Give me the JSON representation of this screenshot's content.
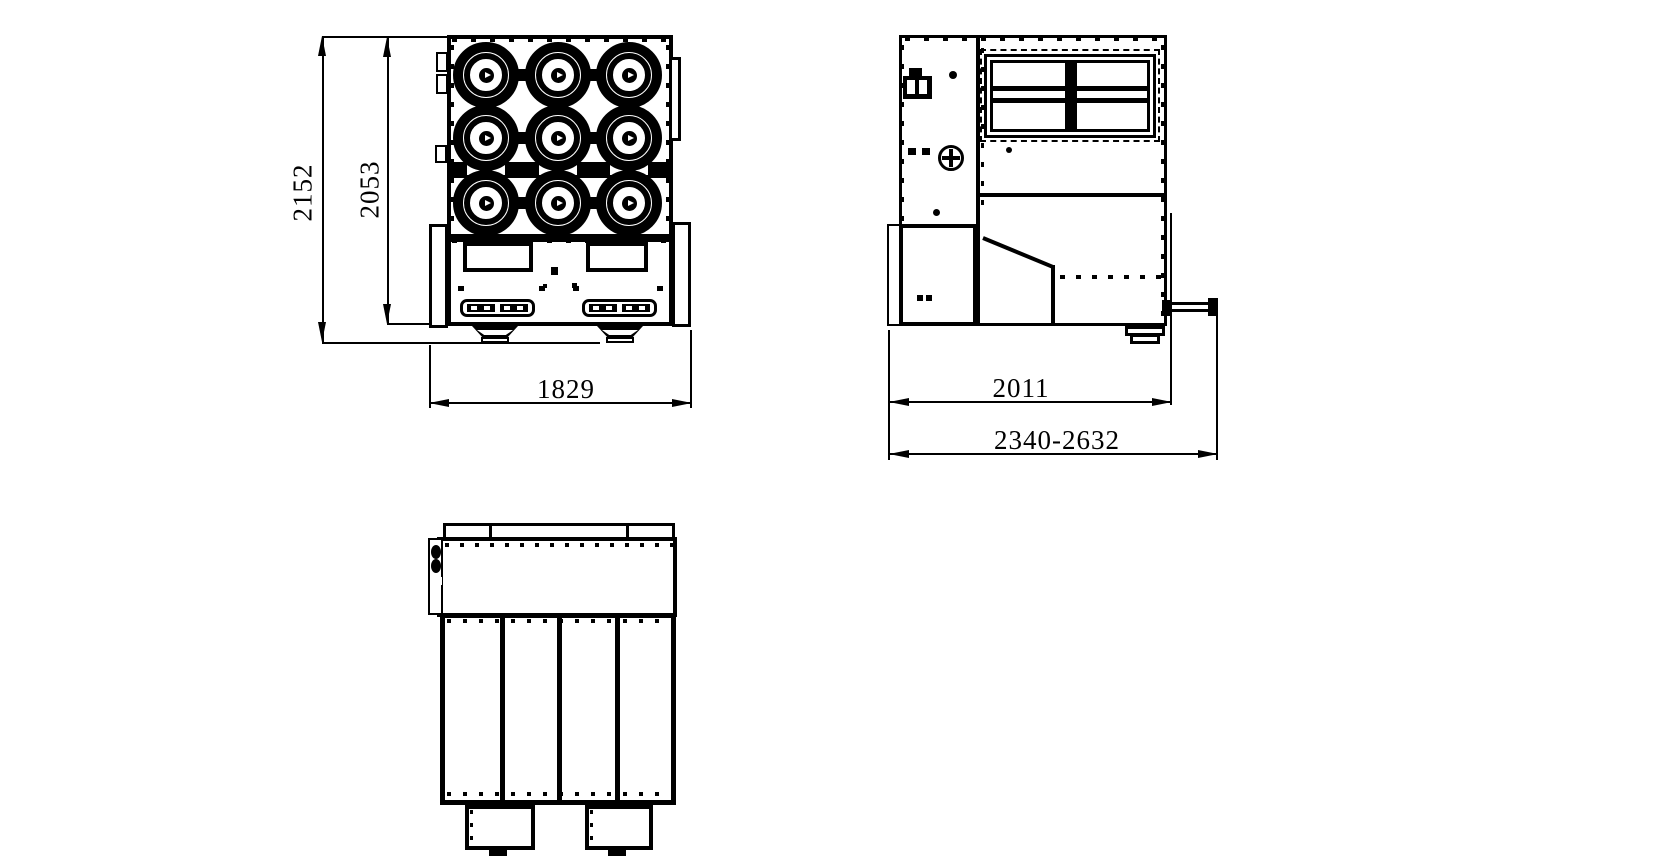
{
  "colors": {
    "line": "#000000",
    "background": "#ffffff"
  },
  "dimensions": {
    "front_overall_height": "2152",
    "front_body_height": "2053",
    "front_width": "1829",
    "side_body_depth": "2011",
    "side_overall_depth_range": "2340-2632"
  }
}
